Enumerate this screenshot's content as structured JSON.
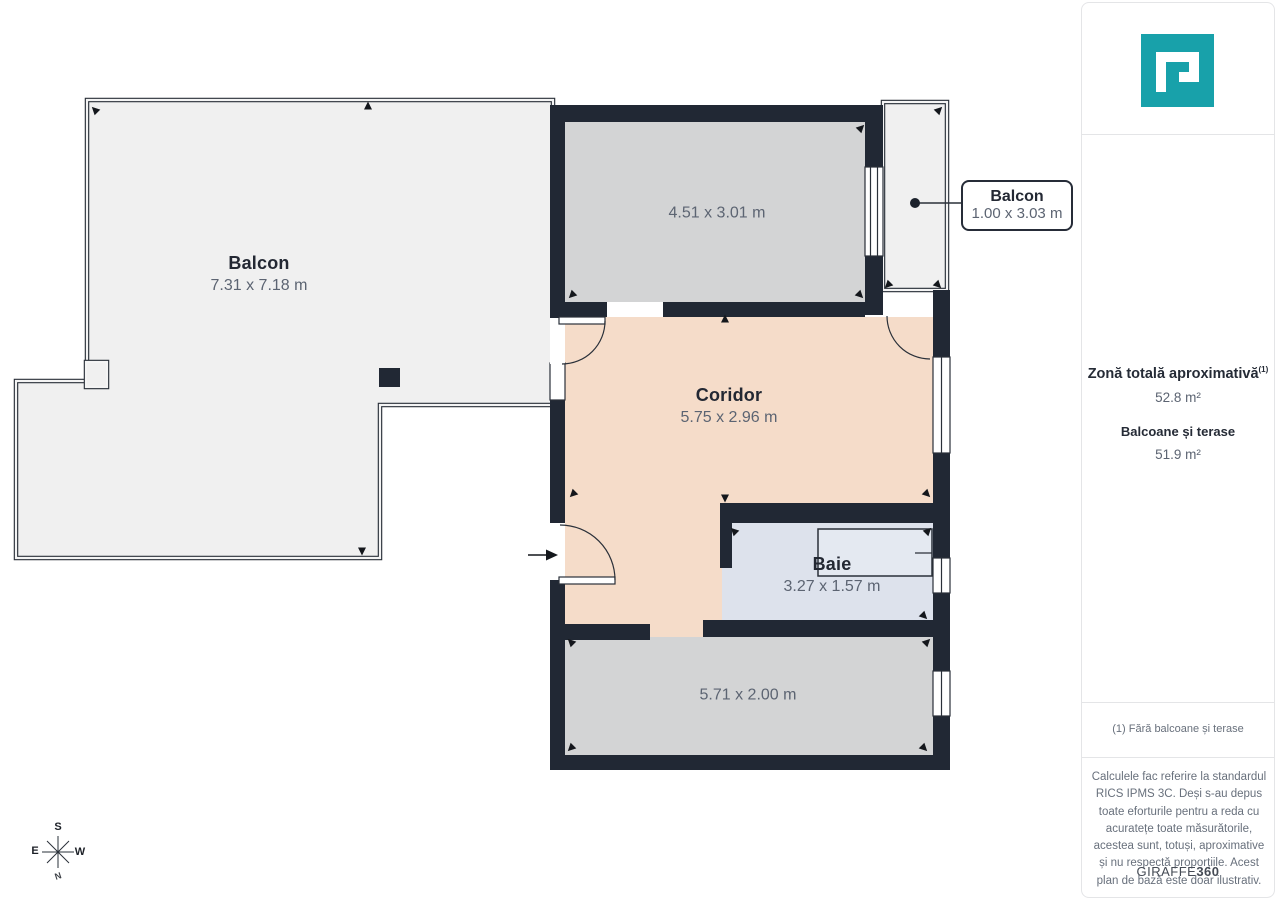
{
  "plan": {
    "rooms": {
      "balcony_left": {
        "name": "Balcon",
        "dimensions": "7.31 x 7.18 m"
      },
      "room_top": {
        "dimensions": "4.51 x 3.01 m"
      },
      "balcony_right": {
        "name": "Balcon",
        "dimensions": "1.00 x 3.03 m"
      },
      "corridor": {
        "name": "Coridor",
        "dimensions": "5.75 x 2.96 m"
      },
      "bathroom": {
        "name": "Baie",
        "dimensions": "3.27 x 1.57 m"
      },
      "room_bottom": {
        "dimensions": "5.71 x 2.00 m"
      }
    },
    "compass": {
      "top": "S",
      "left": "E",
      "right": "W",
      "bottom": "N"
    },
    "colors": {
      "wall": "#212834",
      "room_gray": "#d3d4d5",
      "corridor_peach": "#f5dcc9",
      "bathroom_blue": "#dde2ec",
      "balcony_gray": "#f0f0f0",
      "accent_teal": "#18a1aa"
    }
  },
  "sidebar": {
    "total_area_label": "Zonă totală aproximativă",
    "total_area_sup": "(1)",
    "total_area_value": "52.8 m²",
    "balconies_label": "Balcoane și terase",
    "balconies_value": "51.9 m²",
    "footnote": "(1) Fără balcoane și terase",
    "disclaimer": "Calculele fac referire la standardul RICS IPMS 3C. Deși s-au depus toate eforturile pentru a reda cu acuratețe toate măsurătorile, acestea sunt, totuși, aproximative și nu respectă proporțiile. Acest plan de bază este doar ilustrativ.",
    "brand_name": "GIRAFFE",
    "brand_number": "360"
  }
}
